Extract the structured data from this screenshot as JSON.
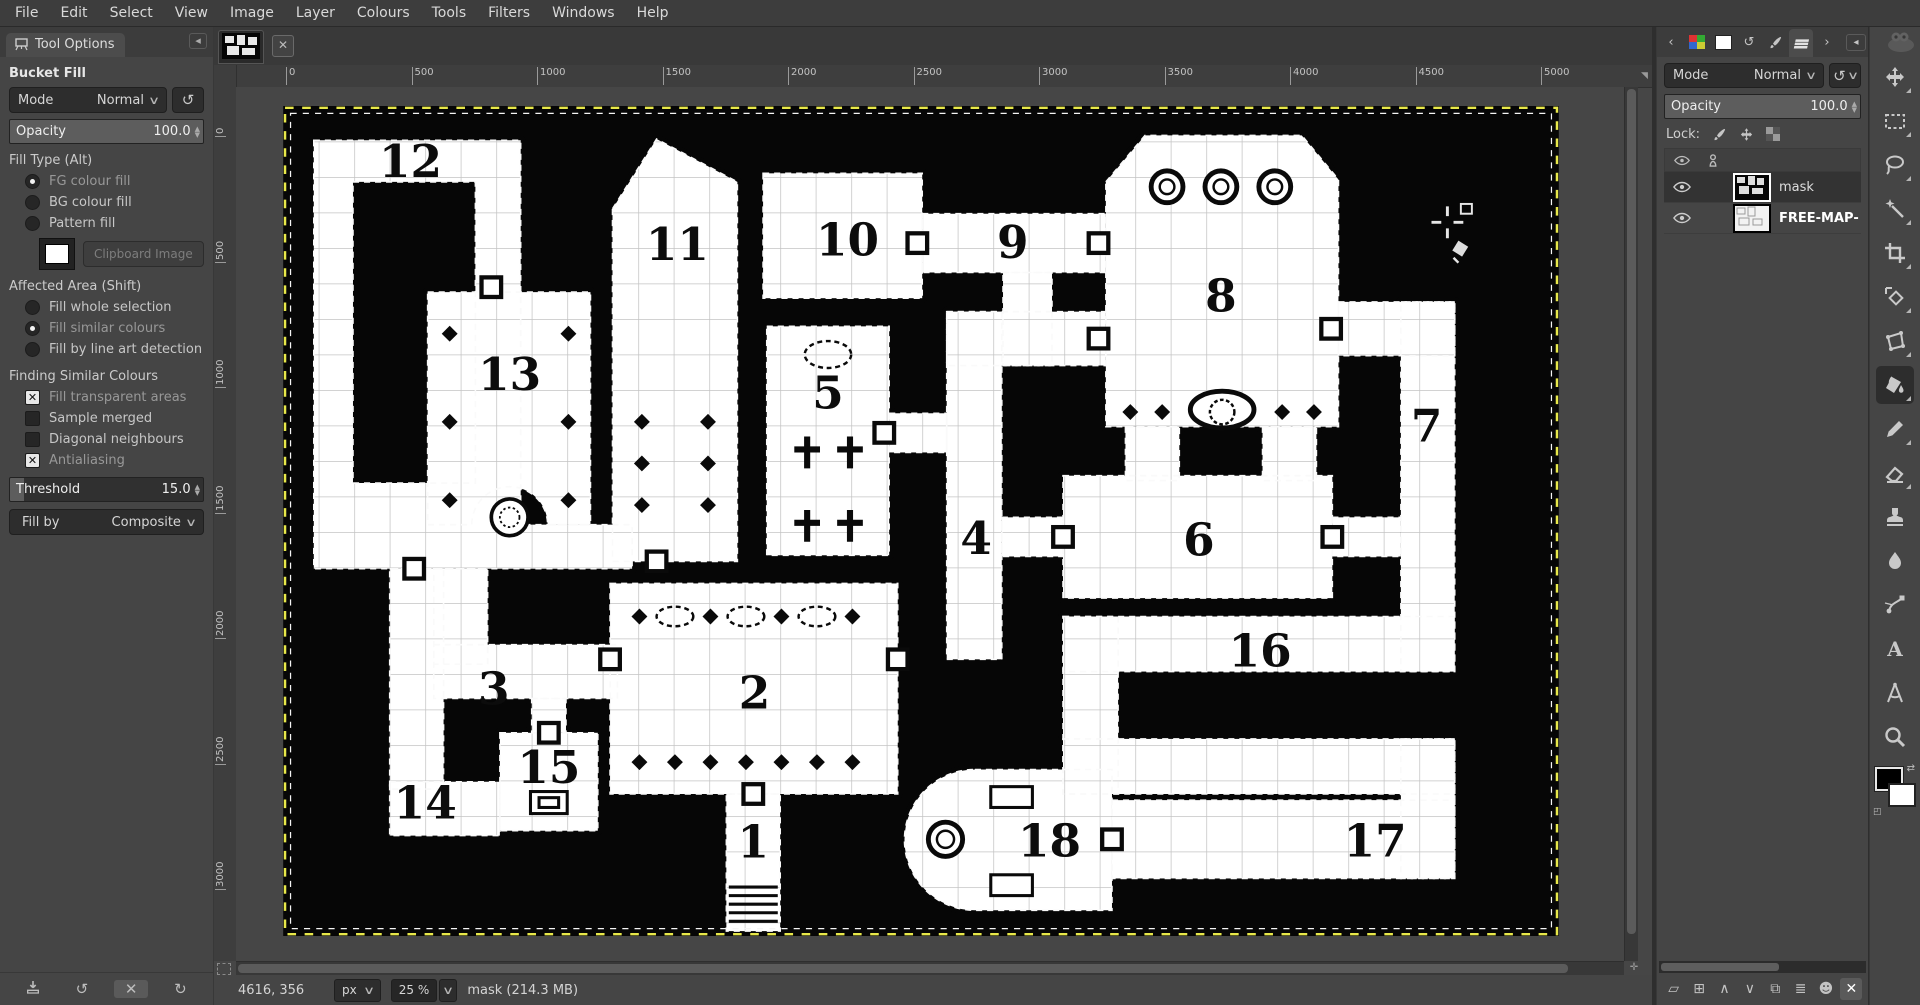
{
  "window": {
    "menu": [
      "File",
      "Edit",
      "Select",
      "View",
      "Image",
      "Layer",
      "Colours",
      "Tools",
      "Filters",
      "Windows",
      "Help"
    ]
  },
  "tool_options": {
    "tab_label": "Tool Options",
    "title": "Bucket Fill",
    "mode_label": "Mode",
    "mode_value": "Normal",
    "opacity_label": "Opacity",
    "opacity_value": "100.0",
    "fill_type_label": "Fill Type  (Alt)",
    "fill_type_options": [
      {
        "label": "FG colour fill",
        "selected": true
      },
      {
        "label": "BG colour fill",
        "selected": false
      },
      {
        "label": "Pattern fill",
        "selected": false
      }
    ],
    "clipboard_button": "Clipboard Image",
    "affected_label": "Affected Area  (Shift)",
    "affected_options": [
      {
        "label": "Fill whole selection",
        "selected": false
      },
      {
        "label": "Fill similar colours",
        "selected": true
      },
      {
        "label": "Fill by line art detection",
        "selected": false
      }
    ],
    "finding_label": "Finding Similar Colours",
    "finding_options": [
      {
        "label": "Fill transparent areas",
        "checked": true
      },
      {
        "label": "Sample merged",
        "checked": false
      },
      {
        "label": "Diagonal neighbours",
        "checked": false
      },
      {
        "label": "Antialiasing",
        "checked": true
      }
    ],
    "threshold_label": "Threshold",
    "threshold_value": "15.0",
    "fill_by_label": "Fill by",
    "fill_by_value": "Composite"
  },
  "canvas": {
    "ruler_top": [
      "0",
      "500",
      "1000",
      "1500",
      "2000",
      "2500",
      "3000",
      "3500",
      "4000",
      "4500",
      "5000"
    ],
    "ruler_left": [
      "0",
      "500",
      "1000",
      "1500",
      "2000",
      "2500",
      "3000"
    ],
    "rooms": [
      {
        "n": "12",
        "x": 104,
        "y": 58
      },
      {
        "n": "13",
        "x": 185,
        "y": 232
      },
      {
        "n": "11",
        "x": 322,
        "y": 126
      },
      {
        "n": "10",
        "x": 461,
        "y": 122
      },
      {
        "n": "9",
        "x": 596,
        "y": 124
      },
      {
        "n": "8",
        "x": 766,
        "y": 168
      },
      {
        "n": "7",
        "x": 934,
        "y": 274
      },
      {
        "n": "5",
        "x": 445,
        "y": 247
      },
      {
        "n": "4",
        "x": 566,
        "y": 366
      },
      {
        "n": "6",
        "x": 748,
        "y": 367
      },
      {
        "n": "16",
        "x": 798,
        "y": 458
      },
      {
        "n": "3",
        "x": 172,
        "y": 489
      },
      {
        "n": "2",
        "x": 385,
        "y": 492
      },
      {
        "n": "15",
        "x": 217,
        "y": 553
      },
      {
        "n": "14",
        "x": 116,
        "y": 582
      },
      {
        "n": "1",
        "x": 384,
        "y": 614
      },
      {
        "n": "18",
        "x": 626,
        "y": 613
      },
      {
        "n": "17",
        "x": 892,
        "y": 613
      }
    ],
    "statusbar": {
      "position": "4616, 356",
      "unit": "px",
      "zoom": "25 %",
      "title": "mask (214.3 MB)"
    }
  },
  "layers_panel": {
    "tab_icons": [
      "back-arrow-icon",
      "palette-icon",
      "bg-swatch-icon",
      "undo-history-icon",
      "brush-icon",
      "layers-icon",
      "forward-arrow-icon",
      "tab-menu-icon"
    ],
    "mode_label": "Mode",
    "mode_value": "Normal",
    "opacity_label": "Opacity",
    "opacity_value": "100.0",
    "lock_label": "Lock:",
    "layers": [
      {
        "name": "mask",
        "selected": true,
        "bold": false
      },
      {
        "name": "FREE-MAP-",
        "selected": false,
        "bold": true
      }
    ],
    "buttons": [
      "new-layer",
      "new-group",
      "raise-layer",
      "lower-layer",
      "duplicate-layer",
      "merge-layer",
      "add-mask",
      "delete-layer"
    ]
  },
  "toolbox": {
    "tools": [
      {
        "name": "move",
        "active": false
      },
      {
        "name": "rect-select",
        "active": false
      },
      {
        "name": "free-select",
        "active": false
      },
      {
        "name": "fuzzy-select",
        "active": false
      },
      {
        "name": "crop",
        "active": false
      },
      {
        "name": "transform",
        "active": false
      },
      {
        "name": "handle-transform",
        "active": false
      },
      {
        "name": "bucket-fill",
        "active": true
      },
      {
        "name": "pencil",
        "active": false
      },
      {
        "name": "eraser",
        "active": false
      },
      {
        "name": "clone",
        "active": false
      },
      {
        "name": "smudge",
        "active": false
      },
      {
        "name": "paths",
        "active": false
      },
      {
        "name": "text",
        "active": false
      },
      {
        "name": "measure",
        "active": false
      },
      {
        "name": "zoom",
        "active": false
      }
    ]
  },
  "colors": {
    "panel": "#454545",
    "canvas_bg": "#464646",
    "layer_boundary": "#e8e84a",
    "map_black": "#060606"
  }
}
